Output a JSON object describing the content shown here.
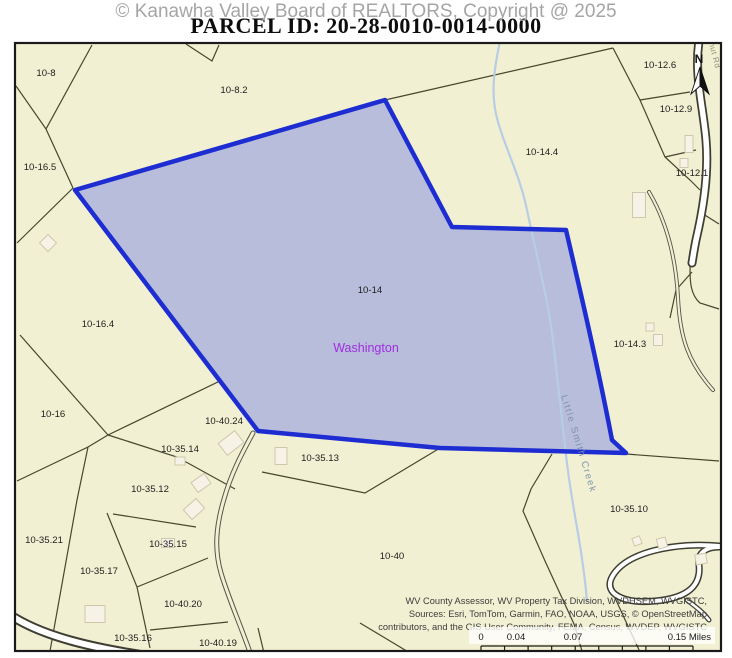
{
  "header": {
    "watermark": "© Kanawha Valley Board of REALTORS, Copyright @ 2025",
    "title": "PARCEL ID: 20-28-0010-0014-0000"
  },
  "map": {
    "background_color": "#f2f0d2",
    "frame_color": "#1a1a1a",
    "line_color": "#46462f",
    "building_fill": "#f6f3e6",
    "building_stroke": "#ccc8ae",
    "selected_parcel": {
      "parcel_id": "10-14",
      "d": "M75,190 L385,100 L452,227 L566,230 C580,290 597,362 612,440 L626,453 L440,448 L258,431 Z",
      "fill": "#b8bddc",
      "stroke": "#1e2dd2"
    },
    "parcel_labels": [
      {
        "text": "10-8",
        "x": 46,
        "y": 76
      },
      {
        "text": "10-8.2",
        "x": 234,
        "y": 93
      },
      {
        "text": "10-12.6",
        "x": 660,
        "y": 68
      },
      {
        "text": "10-12.9",
        "x": 676,
        "y": 112
      },
      {
        "text": "10-14.4",
        "x": 542,
        "y": 155
      },
      {
        "text": "10-12.1",
        "x": 692,
        "y": 176
      },
      {
        "text": "10-16.5",
        "x": 40,
        "y": 170
      },
      {
        "text": "10-14",
        "x": 370,
        "y": 293
      },
      {
        "text": "10-16.4",
        "x": 98,
        "y": 327
      },
      {
        "text": "10-14.3",
        "x": 630,
        "y": 347
      },
      {
        "text": "10-16",
        "x": 53,
        "y": 417
      },
      {
        "text": "10-40.24",
        "x": 224,
        "y": 424
      },
      {
        "text": "10-35.14",
        "x": 180,
        "y": 452
      },
      {
        "text": "10-35.13",
        "x": 320,
        "y": 461
      },
      {
        "text": "10-35.12",
        "x": 150,
        "y": 492
      },
      {
        "text": "10-35.21",
        "x": 44,
        "y": 543
      },
      {
        "text": "10-35.15",
        "x": 168,
        "y": 547
      },
      {
        "text": "10-35.17",
        "x": 99,
        "y": 574
      },
      {
        "text": "10-40",
        "x": 392,
        "y": 559
      },
      {
        "text": "10-35.10",
        "x": 629,
        "y": 512
      },
      {
        "text": "10-40.20",
        "x": 183,
        "y": 607
      },
      {
        "text": "10-35.16",
        "x": 133,
        "y": 641
      },
      {
        "text": "10-40.19",
        "x": 218,
        "y": 646
      }
    ],
    "place_label": {
      "text": "Washington",
      "x": 366,
      "y": 352,
      "color": "#9f2ddf"
    },
    "creek": {
      "name": "Little Smith Creek",
      "d": "M500,41 C494,70 490,95 498,122 C506,150 520,176 527,210 C538,262 548,300 553,340 C558,382 562,420 566,455 C570,492 577,525 581,552 C584,572 586,588 587,602",
      "color": "#b7cde6",
      "label_transform": "translate(561,396) rotate(73)"
    },
    "road_label": {
      "text": "nut Rd",
      "transform": "translate(709,43) rotate(76)"
    },
    "north_arrow": {
      "letter": "N"
    },
    "boundary_lines": [
      "M16,86 L46,129",
      "M92,45 L46,129",
      "M46,129 L73,188",
      "M73,188 L17,243",
      "M186,44 L212,61 L219,45",
      "M385,100 L613,48",
      "M613,48 L640,100 L665,157 L690,180 L700,190",
      "M640,100 L690,92",
      "M665,157 L696,150",
      "M700,212 L719,224",
      "M700,212 L691,252 C688,285 692,296 700,303 L719,309",
      "M692,272 L676,290 L670,318",
      "M626,454 L719,461",
      "M552,454 L531,489 L523,511 L545,561 L574,624 L582,651",
      "M20,335 L108,435",
      "M108,435 L222,380",
      "M108,435 L177,457 L235,489",
      "M108,435 L88,447 L17,481",
      "M88,447 L77,500 L52,640 L50,651",
      "M113,514 L196,527",
      "M107,513 L137,587 L150,648",
      "M137,587 L208,558",
      "M150,630 L228,622",
      "M258,628 L265,657",
      "M440,448 L365,493 L262,472",
      "M360,623 L410,653",
      "M615,598 L640,652"
    ],
    "roads": [
      {
        "d": "M699,41 C694,75 703,105 706,140 C709,175 703,210 696,240 C694,250 693,257 692,263",
        "casing": "#3e3e32",
        "cw": 9,
        "inner": "#ffffff",
        "iw": 5.5
      },
      {
        "d": "M649,192 C668,224 676,260 678,298 C680,338 688,362 713,390",
        "casing": "#55554a",
        "cw": 4,
        "inner": "#f2f0d2",
        "iw": 2.2
      },
      {
        "d": "M719,546 C678,542 626,551 612,577 C603,594 624,604 655,601 C690,598 701,584 699,565 C697,552 707,547 719,547",
        "casing": "#3e3e32",
        "cw": 7,
        "inner": "#ffffff",
        "iw": 4
      },
      {
        "d": "M687,600 C696,607 703,612 709,620",
        "casing": "#3e3e32",
        "cw": 5,
        "inner": "#ffffff",
        "iw": 2.5
      },
      {
        "d": "M15,618 C45,636 90,648 155,657",
        "casing": "#3e3e32",
        "cw": 10,
        "inner": "#ffffff",
        "iw": 6
      },
      {
        "d": "M253,433 C241,455 231,474 224,499 C216,526 214,549 221,573 C228,597 241,626 252,658",
        "casing": "#55554a",
        "cw": 5,
        "inner": "#f2f0d2",
        "iw": 3
      }
    ],
    "buildings": [
      {
        "x": 48,
        "y": 243,
        "w": 12,
        "h": 12,
        "r": 45
      },
      {
        "x": 231,
        "y": 443,
        "w": 21,
        "h": 15,
        "r": -38
      },
      {
        "x": 180,
        "y": 461,
        "w": 10,
        "h": 8,
        "r": 0
      },
      {
        "x": 201,
        "y": 483,
        "w": 16,
        "h": 12,
        "r": -35
      },
      {
        "x": 95,
        "y": 614,
        "w": 20,
        "h": 17,
        "r": 0
      },
      {
        "x": 168,
        "y": 543,
        "w": 13,
        "h": 9,
        "r": 0
      },
      {
        "x": 194,
        "y": 509,
        "w": 17,
        "h": 13,
        "r": -42
      },
      {
        "x": 281,
        "y": 456,
        "w": 12,
        "h": 17,
        "r": 0
      },
      {
        "x": 639,
        "y": 205,
        "w": 13,
        "h": 25,
        "r": 0
      },
      {
        "x": 689,
        "y": 144,
        "w": 8,
        "h": 17,
        "r": 0
      },
      {
        "x": 684,
        "y": 163,
        "w": 8,
        "h": 9,
        "r": 0
      },
      {
        "x": 650,
        "y": 327,
        "w": 8,
        "h": 8,
        "r": 0
      },
      {
        "x": 658,
        "y": 340,
        "w": 9,
        "h": 11,
        "r": 0
      },
      {
        "x": 637,
        "y": 541,
        "w": 8,
        "h": 8,
        "r": -20
      },
      {
        "x": 662,
        "y": 543,
        "w": 9,
        "h": 10,
        "r": -15
      },
      {
        "x": 701,
        "y": 559,
        "w": 11,
        "h": 10,
        "r": -10
      }
    ],
    "scale_bar": {
      "labels": [
        {
          "text": "0",
          "x": 481,
          "anchor": "middle"
        },
        {
          "text": "0.04",
          "x": 516,
          "anchor": "middle"
        },
        {
          "text": "0.07",
          "x": 573,
          "anchor": "middle"
        },
        {
          "text": "0.15 Miles",
          "x": 711,
          "anchor": "end"
        }
      ],
      "x1": 481,
      "x2": 693,
      "y": 646,
      "segments": 9,
      "tick_len": 5,
      "label_y": 640
    },
    "attribution": {
      "x": 707,
      "ys": [
        604,
        617,
        630
      ],
      "lines": [
        "WV County Assessor, WV Property Tax Division, WVDHSEM, WVGISTC,",
        "Sources: Esri, TomTom, Garmin, FAO, NOAA, USGS, © OpenStreetMap",
        "contributors, and the GIS User Community, FEMA, Census, WVDEP, WVGISTC"
      ]
    }
  }
}
